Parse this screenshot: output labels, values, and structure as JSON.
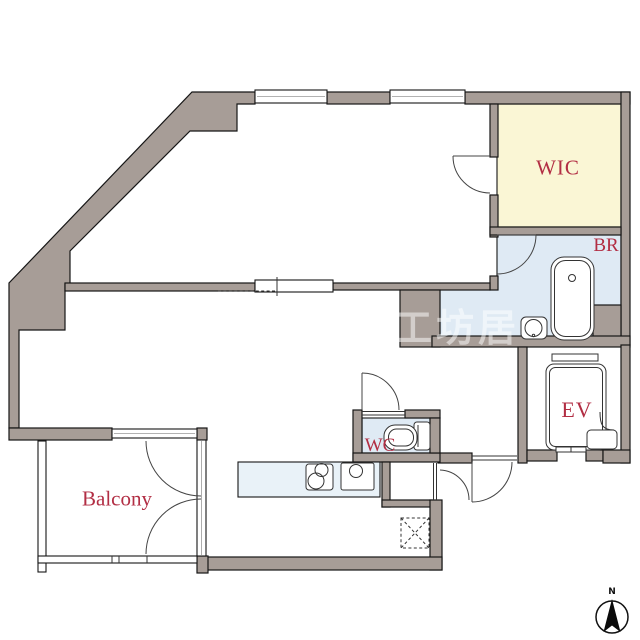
{
  "plan": {
    "rooms": {
      "wic": {
        "label": "WIC",
        "floor_color": "#faf6d5"
      },
      "bathroom": {
        "label": "BR",
        "floor_color": "#dfeaf4"
      },
      "elevator": {
        "label": "EV",
        "floor_color": "#ffffff"
      },
      "toilet": {
        "label": "WC",
        "floor_color": "#dfeaf4"
      },
      "balcony": {
        "label": "Balcony",
        "floor_color": "#ffffff"
      }
    },
    "compass": {
      "label": "N"
    },
    "watermark": {
      "text": "工坊居"
    },
    "colors": {
      "wall": "#a79d97",
      "outline": "#161616",
      "label_red": "#b22e44",
      "kitchen_counter": "#e9f2f8",
      "bath_floor": "#dfeaf4",
      "wic_floor": "#faf6d5"
    }
  }
}
